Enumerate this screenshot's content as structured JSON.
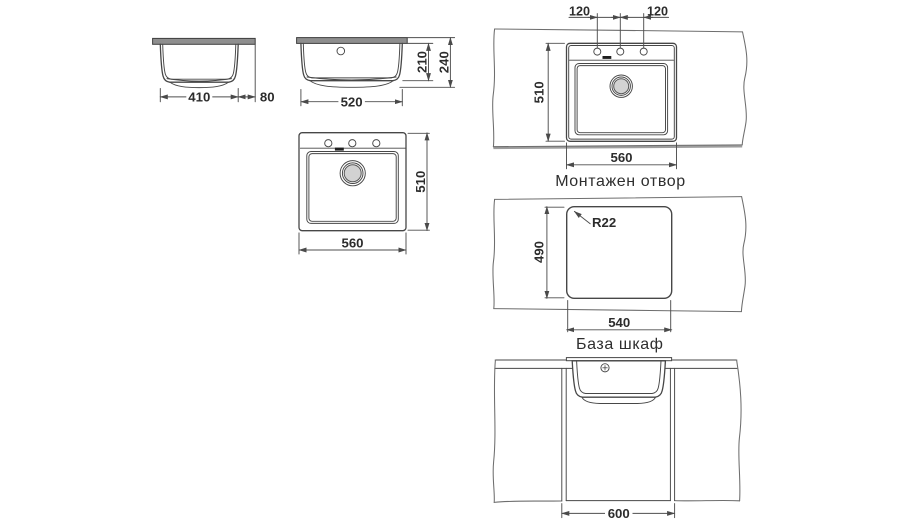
{
  "drawing": {
    "type": "sink installation technical drawing",
    "captions": {
      "mounting_opening": "Монтажен отвор",
      "base_cabinet": "База шкаф"
    },
    "dims": {
      "v1_width": "410",
      "v1_overhang": "80",
      "v2_width": "520",
      "v2_bowl_depth": "210",
      "v2_total_depth": "240",
      "v3_width": "560",
      "v3_depth": "510",
      "v4_spacing_left": "120",
      "v4_spacing_right": "120",
      "v4_width": "560",
      "v4_depth": "510",
      "v5_radius": "R22",
      "v5_depth": "490",
      "v5_width": "540",
      "v6_width": "600"
    },
    "colors": {
      "line": "#474747",
      "text": "#2c2c2c",
      "worktop_fill": "#8e8e8e",
      "drain_fill": "#d2d2d2",
      "overflow_slot": "#1f1f1f",
      "background": "#ffffff"
    }
  }
}
